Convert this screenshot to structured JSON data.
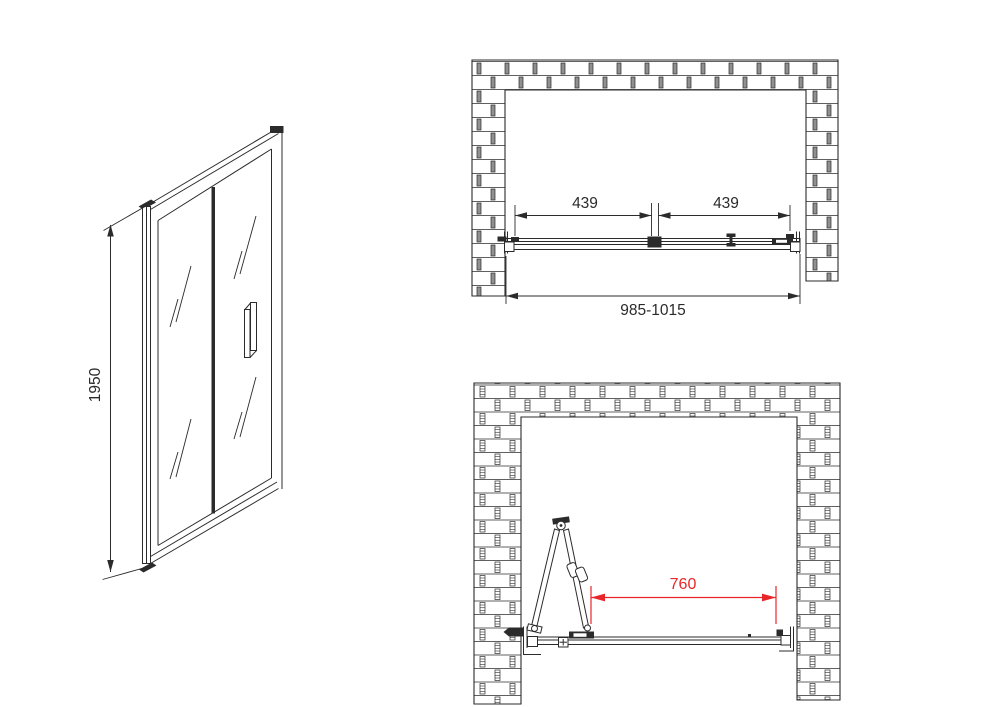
{
  "colors": {
    "line": "#2b2b2b",
    "mortar": "#909090",
    "red": "#e8262a",
    "background": "#ffffff"
  },
  "front_view": {
    "height_label": "1950"
  },
  "plan_view_closed": {
    "left_panel_label": "439",
    "right_panel_label": "439",
    "opening_width_label": "985-1015"
  },
  "plan_view_open": {
    "clearance_label": "760"
  }
}
